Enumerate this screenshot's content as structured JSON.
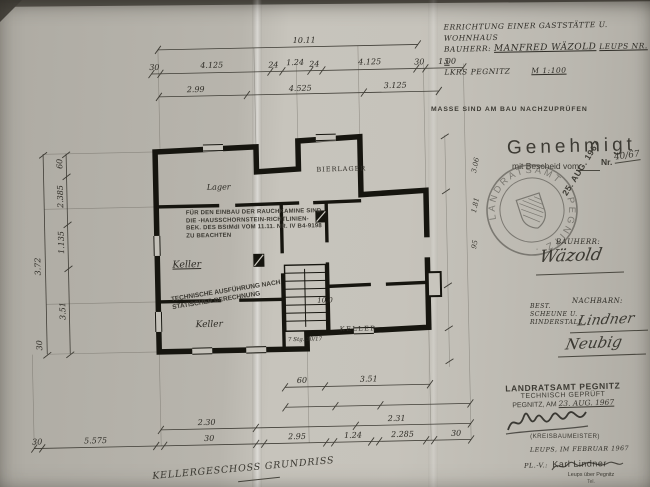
{
  "header_note": {
    "line1": "ERRICHTUNG EINER GASTSTÄTTE U. WOHNHAUS",
    "line2_label": "BAUHERR:",
    "line2_name": "MANFRED WÄZOLD",
    "line2_suffix": "LEUPS NR. 5",
    "line3": "LKRS PEGNITZ",
    "scale": "M 1:100"
  },
  "check_note": "MASSE SIND AM BAU NACHZUPRÜFEN",
  "approval_stamp": {
    "title": "Genehmigt",
    "bescheid": "mit Bescheid vom",
    "nr_label": "Nr.",
    "nr_value": "40/67",
    "date": "25. AUG. 1967"
  },
  "seal": {
    "ring_text": "LANDRATSAMT · PEGNITZ ·"
  },
  "bauherr": {
    "label": "BAUHERR:",
    "signature": "Wäzold"
  },
  "bestand": {
    "line1": "BEST.",
    "line2": "SCHEUNE U.",
    "line3": "RINDERSTALL"
  },
  "nachbarn": {
    "label": "NACHBARN:",
    "sig1": "Lindner",
    "sig2": "Neubig"
  },
  "pruef_block": {
    "line1": "LANDRATSAMT PEGNITZ",
    "line2": "TECHNISCH GEPRÜFT",
    "line3_prefix": "PEGNITZ, AM",
    "line3_date": "23. AUG. 1967",
    "line4": "(KREISBAUMEISTER)"
  },
  "author_block": {
    "line1": "LEUPS, IM FEBRUAR 1967",
    "line2_label": "PL.-V.:",
    "line2_name": "Karl Lindner",
    "line3": "Leups über Pegnitz",
    "line4": "Tel."
  },
  "caption": "KELLERGESCHOSS GRUNDRISS",
  "kamine_stamp": {
    "l1": "FÜR DEN EINBAU DER RAUCHKAMINE SIND",
    "l2": "DIE -HAUSSCHORNSTEIN-RICHTLINIEN-",
    "l3": "BEK. DES BStMdI VOM 11.11. NR. IV B4-9198",
    "l4": "ZU BEACHTEN"
  },
  "statik_stamp": {
    "l1": "TECHNISCHE AUSFÜHRUNG NACH",
    "l2": "STATISCHER BERECHNUNG"
  },
  "plan": {
    "room_top_left": "Lager",
    "room_top_right": "BIERLAGER",
    "room_main": "Keller",
    "room_bottom_left": "Keller",
    "room_right": "KELLER",
    "stair_note": "7 Stg. 30/17",
    "hand_note": "10,0"
  },
  "dims": {
    "top_overall": "10.11",
    "top_chain": [
      "30",
      "4.125",
      "24",
      "1.24",
      "24",
      "4.125",
      "30",
      "1.00"
    ],
    "top_inner": [
      "2.99",
      "4.525",
      "3.125"
    ],
    "left_outer": [
      "3.72",
      "30"
    ],
    "left_inner": [
      "60",
      "2.385",
      "1.135",
      "3.51"
    ],
    "right_hand": [
      "3.06",
      "1.81",
      "95"
    ],
    "bottom_upper": [
      "60",
      "3.51"
    ],
    "bottom_low": [
      "2.30",
      "2.31"
    ],
    "bottom_chain": [
      "30",
      "5.575",
      "30",
      "2.95",
      "1.24",
      "2.285",
      "30"
    ]
  }
}
